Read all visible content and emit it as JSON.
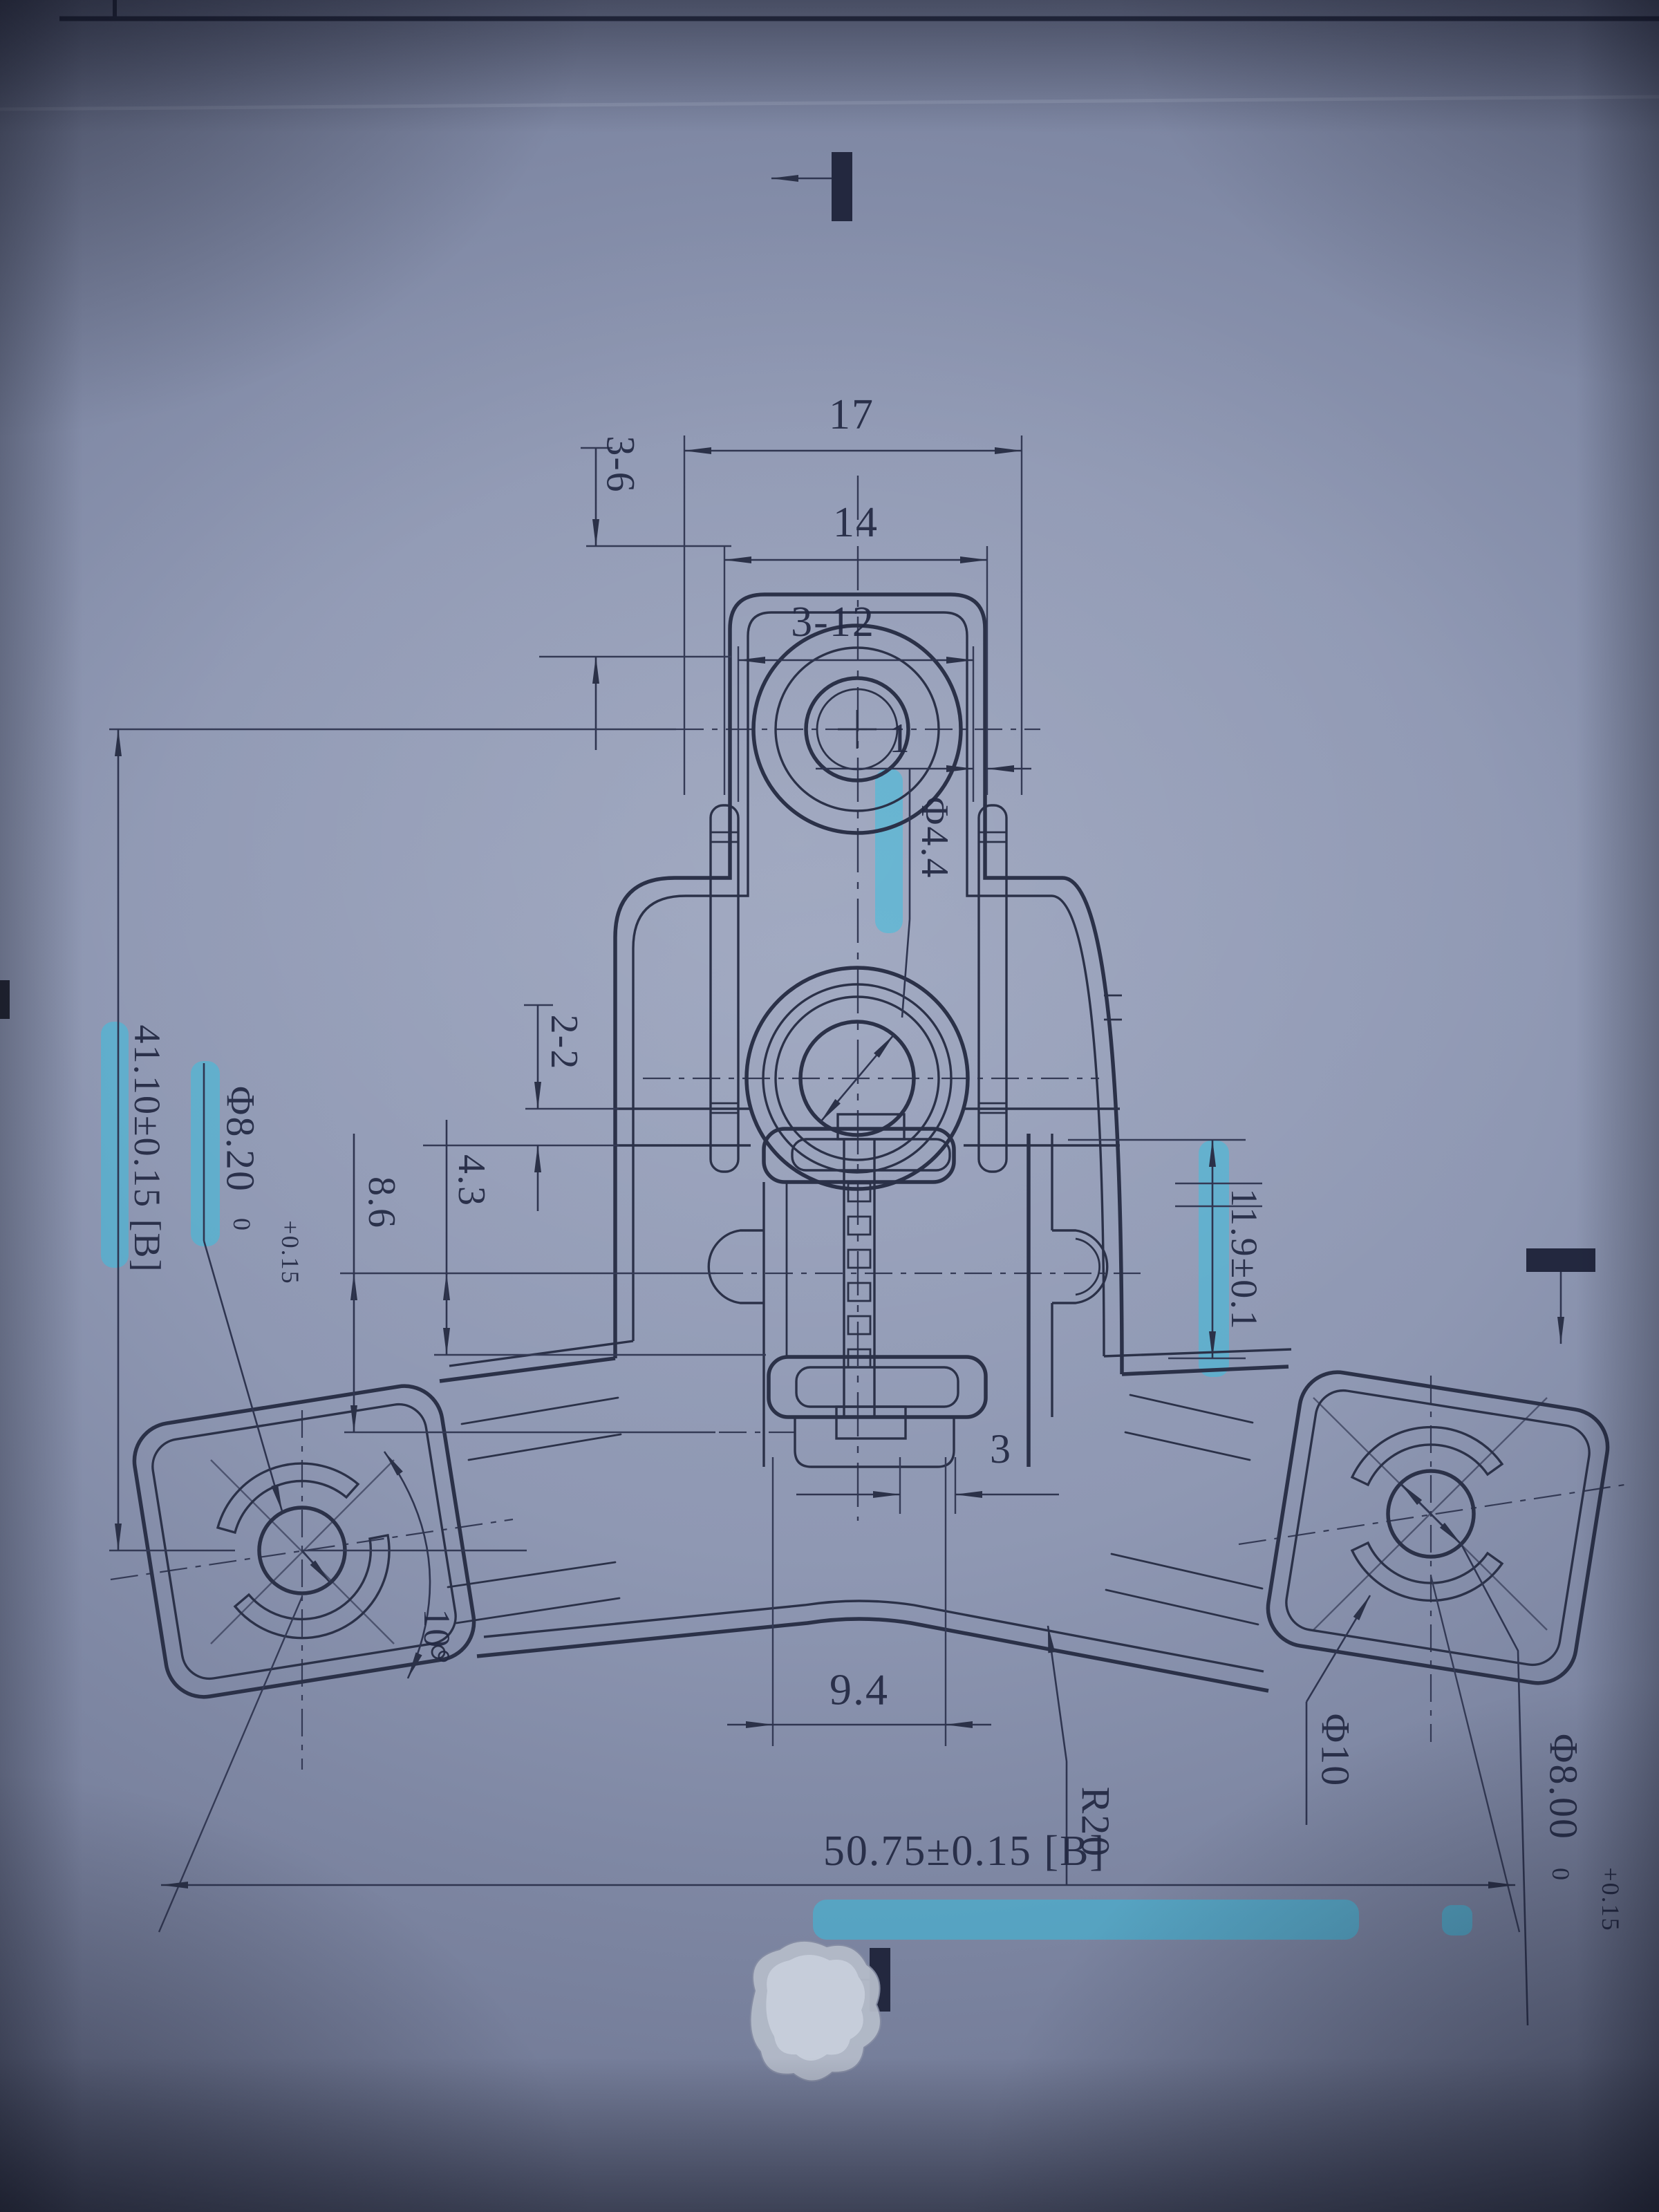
{
  "document": {
    "kind": "photographed engineering drawing of a three-arm bracket",
    "colors": {
      "paper": "#8f98b3",
      "ink": "#2b3148",
      "highlighter": "#2ec4e6"
    }
  },
  "labels": {
    "d17": "17",
    "d14": "14",
    "d3_12": "3-12",
    "d1": "1",
    "d3_6": "3-6",
    "phi44": "Φ4.4",
    "d41": "41.10±0.15 [B]",
    "phi820": "Φ8.20",
    "phi820_tol_upper": "+0.15",
    "phi820_tol_lower": "0",
    "d2_2": "2-2",
    "d4_3": "4.3",
    "d8_6": "8.6",
    "d11_9": "11.9±0.1",
    "d3": "3",
    "d9_4": "9.4",
    "r20": "R20",
    "phi10": "Φ10",
    "phi800": "Φ8.00",
    "phi800_tol_upper": "+0.15",
    "phi800_tol_lower": "0",
    "d50_75": "50.75±0.15 [B]",
    "angle10": "10°"
  }
}
